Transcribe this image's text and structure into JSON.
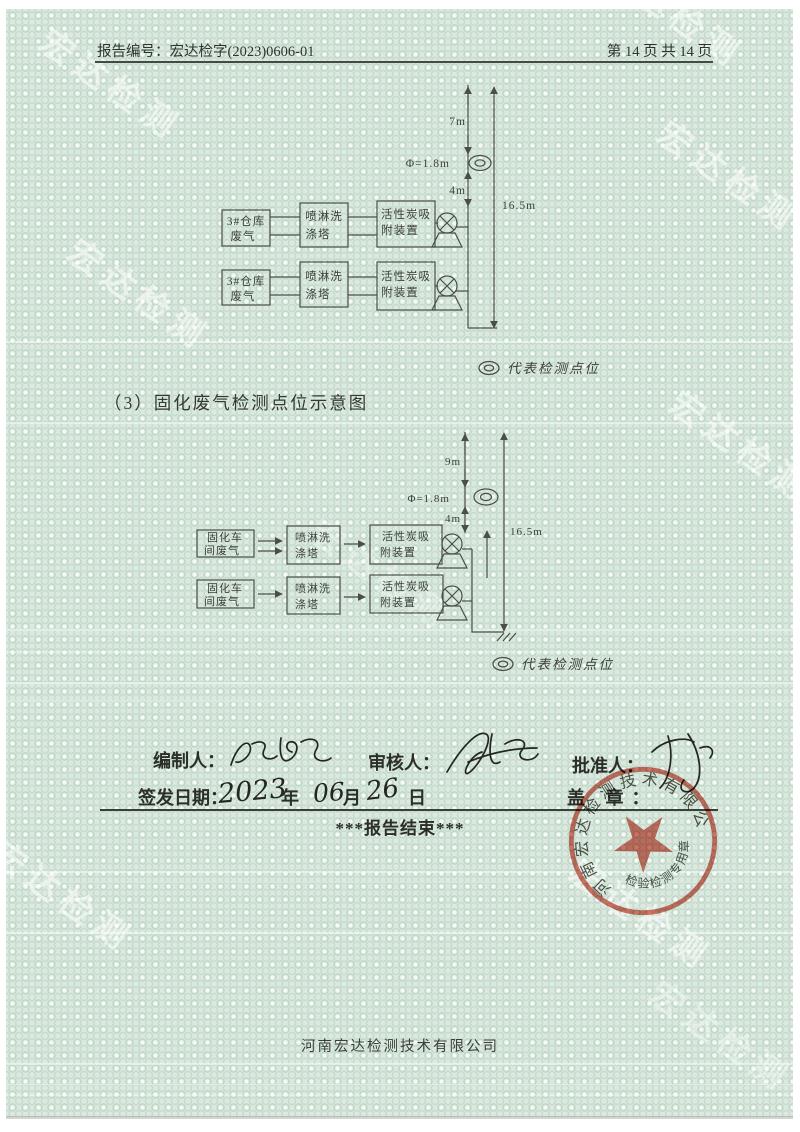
{
  "header": {
    "report_no_label": "报告编号：",
    "report_no": "宏达检字(2023)0606-01",
    "page_info": "第 14 页 共 14 页"
  },
  "watermark_text": "宏达检测",
  "diagram1": {
    "rows": [
      {
        "source_l1": "3#仓库",
        "source_l2": "废气",
        "scrubber_l1": "喷淋洗",
        "scrubber_l2": "涤塔",
        "adsorber_l1": "活性炭吸",
        "adsorber_l2": "附装置"
      },
      {
        "source_l1": "3#仓库",
        "source_l2": "废气",
        "scrubber_l1": "喷淋洗",
        "scrubber_l2": "涤塔",
        "adsorber_l1": "活性炭吸",
        "adsorber_l2": "附装置"
      }
    ],
    "dims": {
      "upper": "7m",
      "diameter": "Φ=1.8m",
      "lower": "4m",
      "total": "16.5m"
    },
    "legend_label": "代表检测点位"
  },
  "section3_heading": "（3）固化废气检测点位示意图",
  "diagram2": {
    "rows": [
      {
        "source_l1": "固化车",
        "source_l2": "间废气",
        "scrubber_l1": "喷淋洗",
        "scrubber_l2": "涤塔",
        "adsorber_l1": "活性炭吸",
        "adsorber_l2": "附装置"
      },
      {
        "source_l1": "固化车",
        "source_l2": "间废气",
        "scrubber_l1": "喷淋洗",
        "scrubber_l2": "涤塔",
        "adsorber_l1": "活性炭吸",
        "adsorber_l2": "附装置"
      }
    ],
    "dims": {
      "upper": "9m",
      "diameter": "Φ=1.8m",
      "lower": "4m",
      "total": "16.5m"
    },
    "legend_label": "代表检测点位"
  },
  "signatures": {
    "prepared_label": "编制人：",
    "reviewed_label": "审核人：",
    "approved_label": "批准人：",
    "issue_date_label": "签发日期：",
    "issue_year": "2023",
    "year_suffix": "年",
    "issue_month": "06",
    "month_suffix": "月",
    "issue_day": "26",
    "day_suffix": "日",
    "seal_label": "盖  章："
  },
  "report_end_text": "***报告结束***",
  "stamp": {
    "company_name": "河南宏达检测技术有限公司",
    "seal_type": "检验检测专用章"
  },
  "footer_company": "河南宏达检测技术有限公司",
  "colors": {
    "paper_green": "#dde9e0",
    "pattern_green": "#a4cbb2",
    "ink": "#2b2f28",
    "diagram_line": "#4b4f46",
    "stamp_red": "#c8503e"
  }
}
